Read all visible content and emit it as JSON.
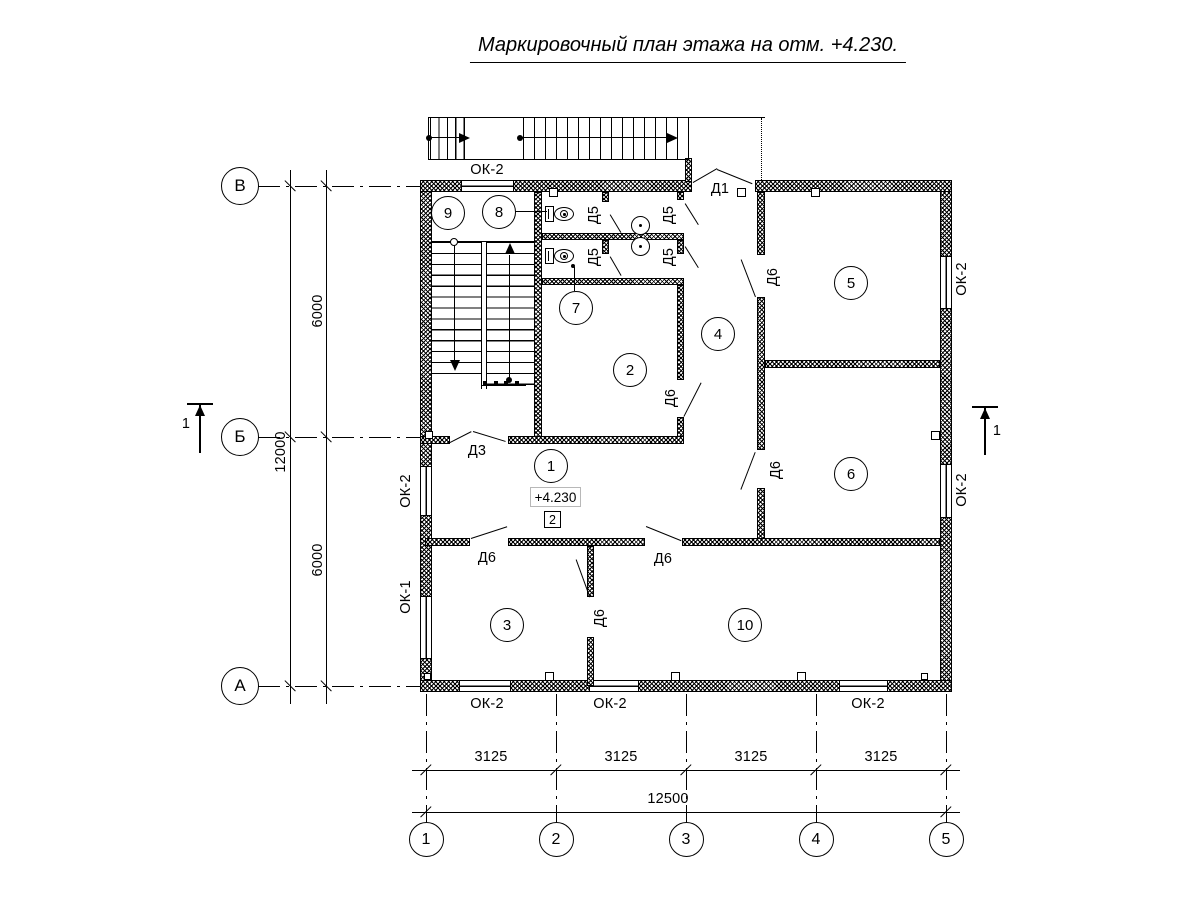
{
  "title": "Маркировочный план этажа на отм. +4.230.",
  "elevation_mark": "+4.230",
  "level_badge": "2",
  "axes": {
    "rows": [
      {
        "label": "В",
        "y": 186
      },
      {
        "label": "Б",
        "y": 437
      },
      {
        "label": "А",
        "y": 686
      }
    ],
    "cols": [
      {
        "label": "1",
        "x": 426
      },
      {
        "label": "2",
        "x": 556
      },
      {
        "label": "3",
        "x": 686
      },
      {
        "label": "4",
        "x": 816
      },
      {
        "label": "5",
        "x": 946
      }
    ]
  },
  "dimensions": {
    "left": [
      {
        "text": "6000",
        "x": 318,
        "y": 311,
        "rot": 90
      },
      {
        "text": "12000",
        "x": 281,
        "y": 452,
        "rot": 90
      },
      {
        "text": "6000",
        "x": 318,
        "y": 560,
        "rot": 90
      }
    ],
    "bottom": [
      {
        "text": "3125",
        "x": 491,
        "y": 757,
        "rot": 0
      },
      {
        "text": "3125",
        "x": 621,
        "y": 757,
        "rot": 0
      },
      {
        "text": "3125",
        "x": 751,
        "y": 757,
        "rot": 0
      },
      {
        "text": "3125",
        "x": 881,
        "y": 757,
        "rot": 0
      },
      {
        "text": "12500",
        "x": 668,
        "y": 799,
        "rot": 0
      }
    ]
  },
  "rooms": [
    {
      "number": "1",
      "x": 551,
      "y": 466
    },
    {
      "number": "2",
      "x": 630,
      "y": 370
    },
    {
      "number": "3",
      "x": 507,
      "y": 625
    },
    {
      "number": "4",
      "x": 718,
      "y": 334
    },
    {
      "number": "5",
      "x": 851,
      "y": 283
    },
    {
      "number": "6",
      "x": 851,
      "y": 474
    },
    {
      "number": "7",
      "x": 576,
      "y": 308
    },
    {
      "number": "8",
      "x": 499,
      "y": 212
    },
    {
      "number": "9",
      "x": 448,
      "y": 213
    },
    {
      "number": "10",
      "x": 745,
      "y": 625
    }
  ],
  "door_labels": [
    {
      "text": "Д1",
      "x": 720,
      "y": 189,
      "rot": 0
    },
    {
      "text": "Д3",
      "x": 477,
      "y": 451,
      "rot": 0
    },
    {
      "text": "Д5",
      "x": 594,
      "y": 215,
      "rot": 90
    },
    {
      "text": "Д5",
      "x": 669,
      "y": 215,
      "rot": 90
    },
    {
      "text": "Д5",
      "x": 594,
      "y": 257,
      "rot": 90
    },
    {
      "text": "Д5",
      "x": 669,
      "y": 257,
      "rot": 90
    },
    {
      "text": "Д6",
      "x": 773,
      "y": 277,
      "rot": 90
    },
    {
      "text": "Д6",
      "x": 671,
      "y": 398,
      "rot": 90
    },
    {
      "text": "Д6",
      "x": 776,
      "y": 470,
      "rot": 90
    },
    {
      "text": "Д6",
      "x": 487,
      "y": 558,
      "rot": 0
    },
    {
      "text": "Д6",
      "x": 663,
      "y": 559,
      "rot": 0
    },
    {
      "text": "Д6",
      "x": 600,
      "y": 618,
      "rot": 90
    }
  ],
  "window_labels": [
    {
      "text": "ОК-2",
      "x": 487,
      "y": 170,
      "rot": 0
    },
    {
      "text": "ОК-2",
      "x": 406,
      "y": 491,
      "rot": 90
    },
    {
      "text": "ОК-1",
      "x": 406,
      "y": 597,
      "rot": 90
    },
    {
      "text": "ОК-2",
      "x": 962,
      "y": 279,
      "rot": 90
    },
    {
      "text": "ОК-2",
      "x": 962,
      "y": 490,
      "rot": 90
    },
    {
      "text": "ОК-2",
      "x": 487,
      "y": 704,
      "rot": 0
    },
    {
      "text": "ОК-2",
      "x": 610,
      "y": 704,
      "rot": 0
    },
    {
      "text": "ОК-2",
      "x": 868,
      "y": 704,
      "rot": 0
    }
  ],
  "section_marks": [
    {
      "text": "1",
      "x": 186,
      "y": 424
    },
    {
      "text": "1",
      "x": 997,
      "y": 431
    }
  ]
}
